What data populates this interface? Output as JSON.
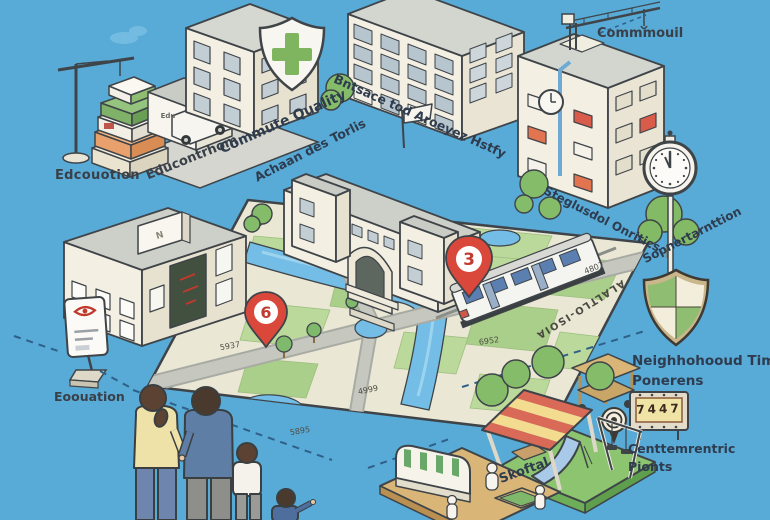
{
  "scene": {
    "background_color": "#58AAD7",
    "theme": "isometric neighborhood quality illustration with central street map"
  },
  "labels": {
    "education_left": "Edcouotion",
    "education_diagonal": "Educontrhom",
    "commute_quality": "Commute Quality",
    "school_name": "Achaan des Torlis",
    "apartments_caption": "Bntsace tod Aroeyez Hstfy",
    "crane_caption": "Commmouil",
    "right_building_caption": "Steglusdol Onritics",
    "clock_caption": "Sopnertarnttion",
    "shield_caption_line1": "Neighhohooud Time",
    "shield_caption_line2": "Ponerens",
    "points_caption_line1": "Centtemrentric",
    "points_caption_line2": "Pionts",
    "playground_caption": "Skoftal",
    "education_bottom": "Eoouation",
    "shed_sign": "Edu",
    "rooftop_sign": "N"
  },
  "map": {
    "edge_label": "ALALTLO-ISOIA",
    "street_numbers": [
      "5937",
      "4999",
      "5895",
      "6952",
      "4807"
    ],
    "pins": [
      {
        "number": "6"
      },
      {
        "number": "3"
      }
    ],
    "scoreboard_value": "7447"
  },
  "colors": {
    "sky": "#58AAD7",
    "label_text": "#2E3C4E",
    "pin_red": "#D9483B",
    "map_base": "#EAE7D5",
    "map_green": "#BCD99C",
    "road_gray": "#C6C8C0",
    "water_blue": "#74BDE6",
    "shield_green": "#8FBE72",
    "canopy_red": "#D96A58",
    "canopy_yellow": "#F3DC8F",
    "building_cream": "#F3EFE2"
  }
}
